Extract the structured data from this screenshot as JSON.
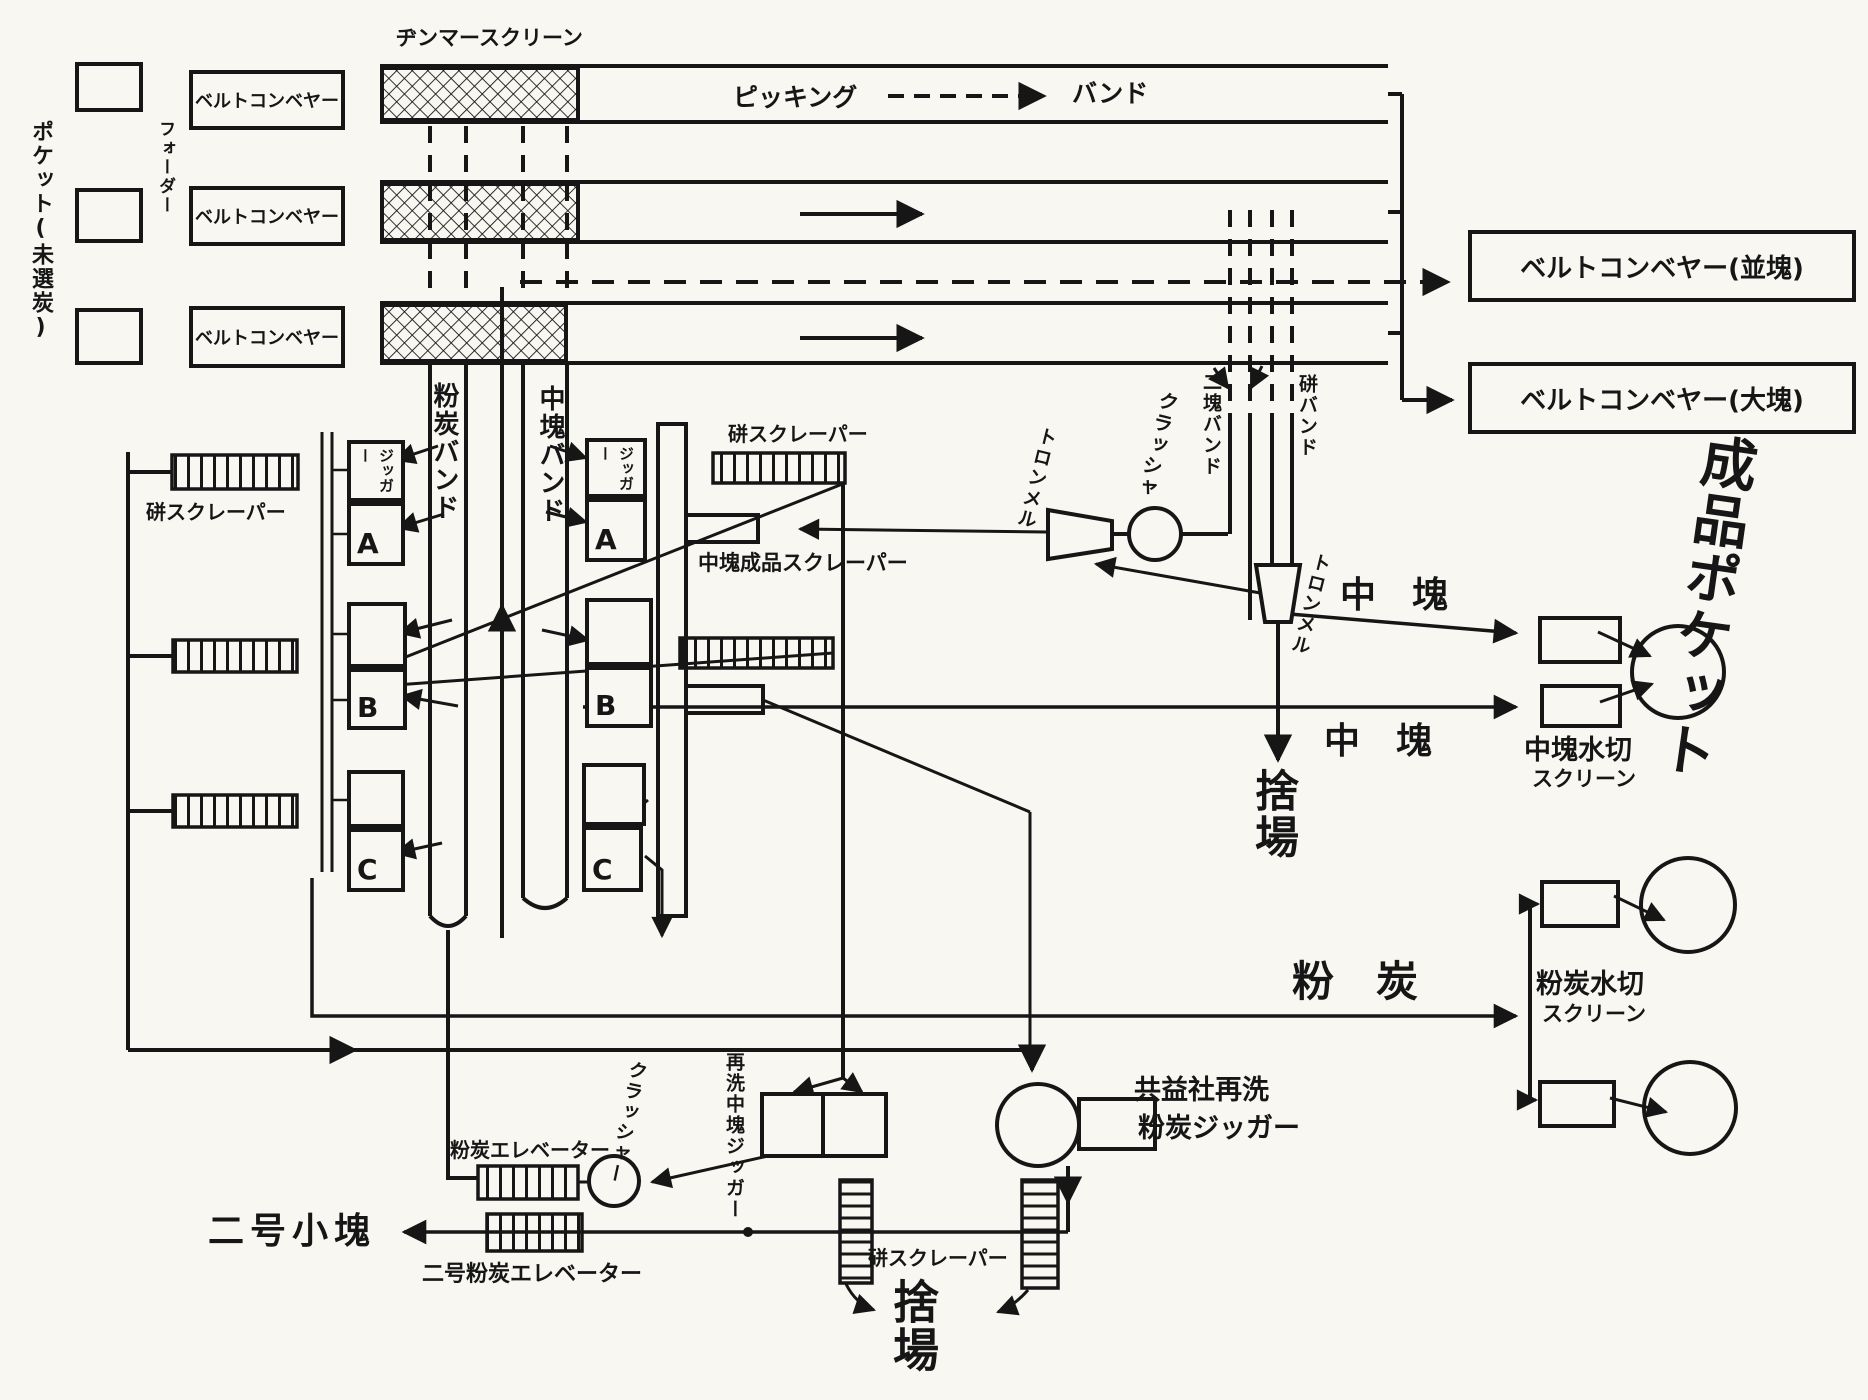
{
  "labels": {
    "pocket": "ポケット(未選炭)",
    "feeder": "フォーダー",
    "belt_conveyor": "ベルトコンベヤー",
    "jimmer_screen": "ヂンマースクリーン",
    "picking": "ピッキング",
    "band": "バンド",
    "belt_conveyor_medium": "ベルトコンベヤー(並塊)",
    "belt_conveyor_large": "ベルトコンベヤー(大塊)",
    "refuse_scraper": "硑スクレーパー",
    "fine_coal_band": "粉炭バンド",
    "medium_lump_band": "中塊バンド",
    "jigger": "ジッガー",
    "cell_a": "A",
    "cell_b": "B",
    "cell_c": "C",
    "medium_product_scraper": "中塊成品スクレーパー",
    "trommel": "トロンメル",
    "crusher": "クラッシャ",
    "crusher_long": "クラッシャー",
    "two_lump_band": "二塊バンド",
    "refuse_band": "硑バンド",
    "medium_lump": "中　塊",
    "dump": "捨場",
    "medium_dewater": "中塊水切",
    "screen": "スクリーン",
    "fine_coal": "粉　炭",
    "fine_dewater": "粉炭水切",
    "product_pocket": "成品ポケット",
    "rewash_medium_jigger": "再洗中塊ジッガー",
    "kyoeki_line1": "共益社再洗",
    "kyoeki_line2": "粉炭ジッガー",
    "fine_elevator": "粉炭エレベーター",
    "no2_fine_elevator": "二号粉炭エレベーター",
    "no2_small_lump": "二号小塊"
  }
}
